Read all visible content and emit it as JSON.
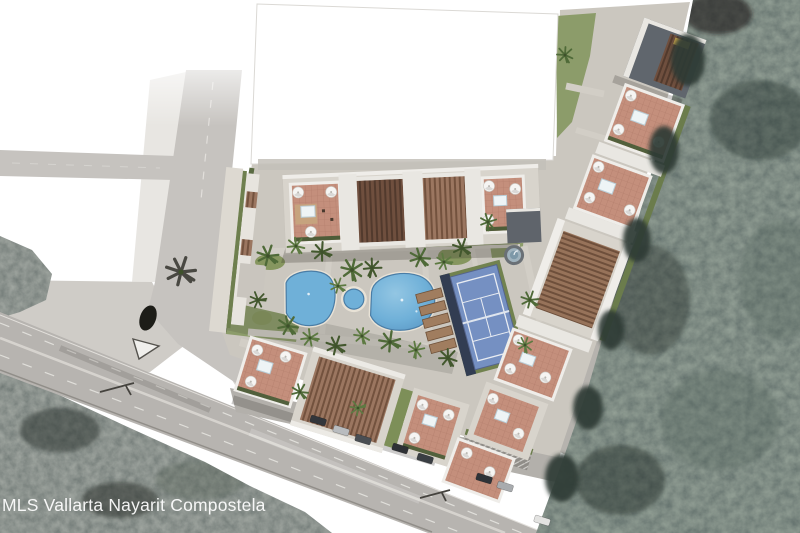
{
  "watermark": {
    "text": "MLS Vallarta Nayarit Compostela"
  },
  "scene": {
    "title": "Condominium master-plan aerial rendering",
    "setting": "Architectural site plan composited over an aerial photo beside a highway and dense jungle",
    "features": [
      {
        "name": "highway",
        "label": "divided highway with lane markings crossing lower left"
      },
      {
        "name": "access-road",
        "label": "access road joining the highway at an intersection"
      },
      {
        "name": "jungle-right",
        "label": "dense jungle covering the east side"
      },
      {
        "name": "jungle-southwest",
        "label": "jungle south of the highway"
      },
      {
        "name": "white-parcel",
        "label": "blank white parcel at top center"
      },
      {
        "name": "main-building",
        "label": "long amenity building with pergola roofs and roof terraces"
      },
      {
        "name": "swimming-pools",
        "label": "two free-form pools, round spa and circular water feature"
      },
      {
        "name": "paddle-court",
        "label": "blue sports court with white lines"
      },
      {
        "name": "roof-terraces",
        "label": "roof terraces with white umbrellas and plunge pools"
      },
      {
        "name": "parking-row",
        "label": "cars parked along the internal drive"
      },
      {
        "name": "palm-landscaping",
        "label": "palm trees around the pool courtyard"
      }
    ],
    "colors": {
      "pool_water": "#6fb0d8",
      "court_surface": "#7590c2",
      "terrace_paver": "#c48f7c",
      "pergola_wood": "#8a6750",
      "building_roof": "#d8d4cc",
      "lawn": "#8c9c6a",
      "asphalt": "#b7b4b0",
      "jungle": "#36423b",
      "watermark_text": "#ffffff"
    }
  }
}
